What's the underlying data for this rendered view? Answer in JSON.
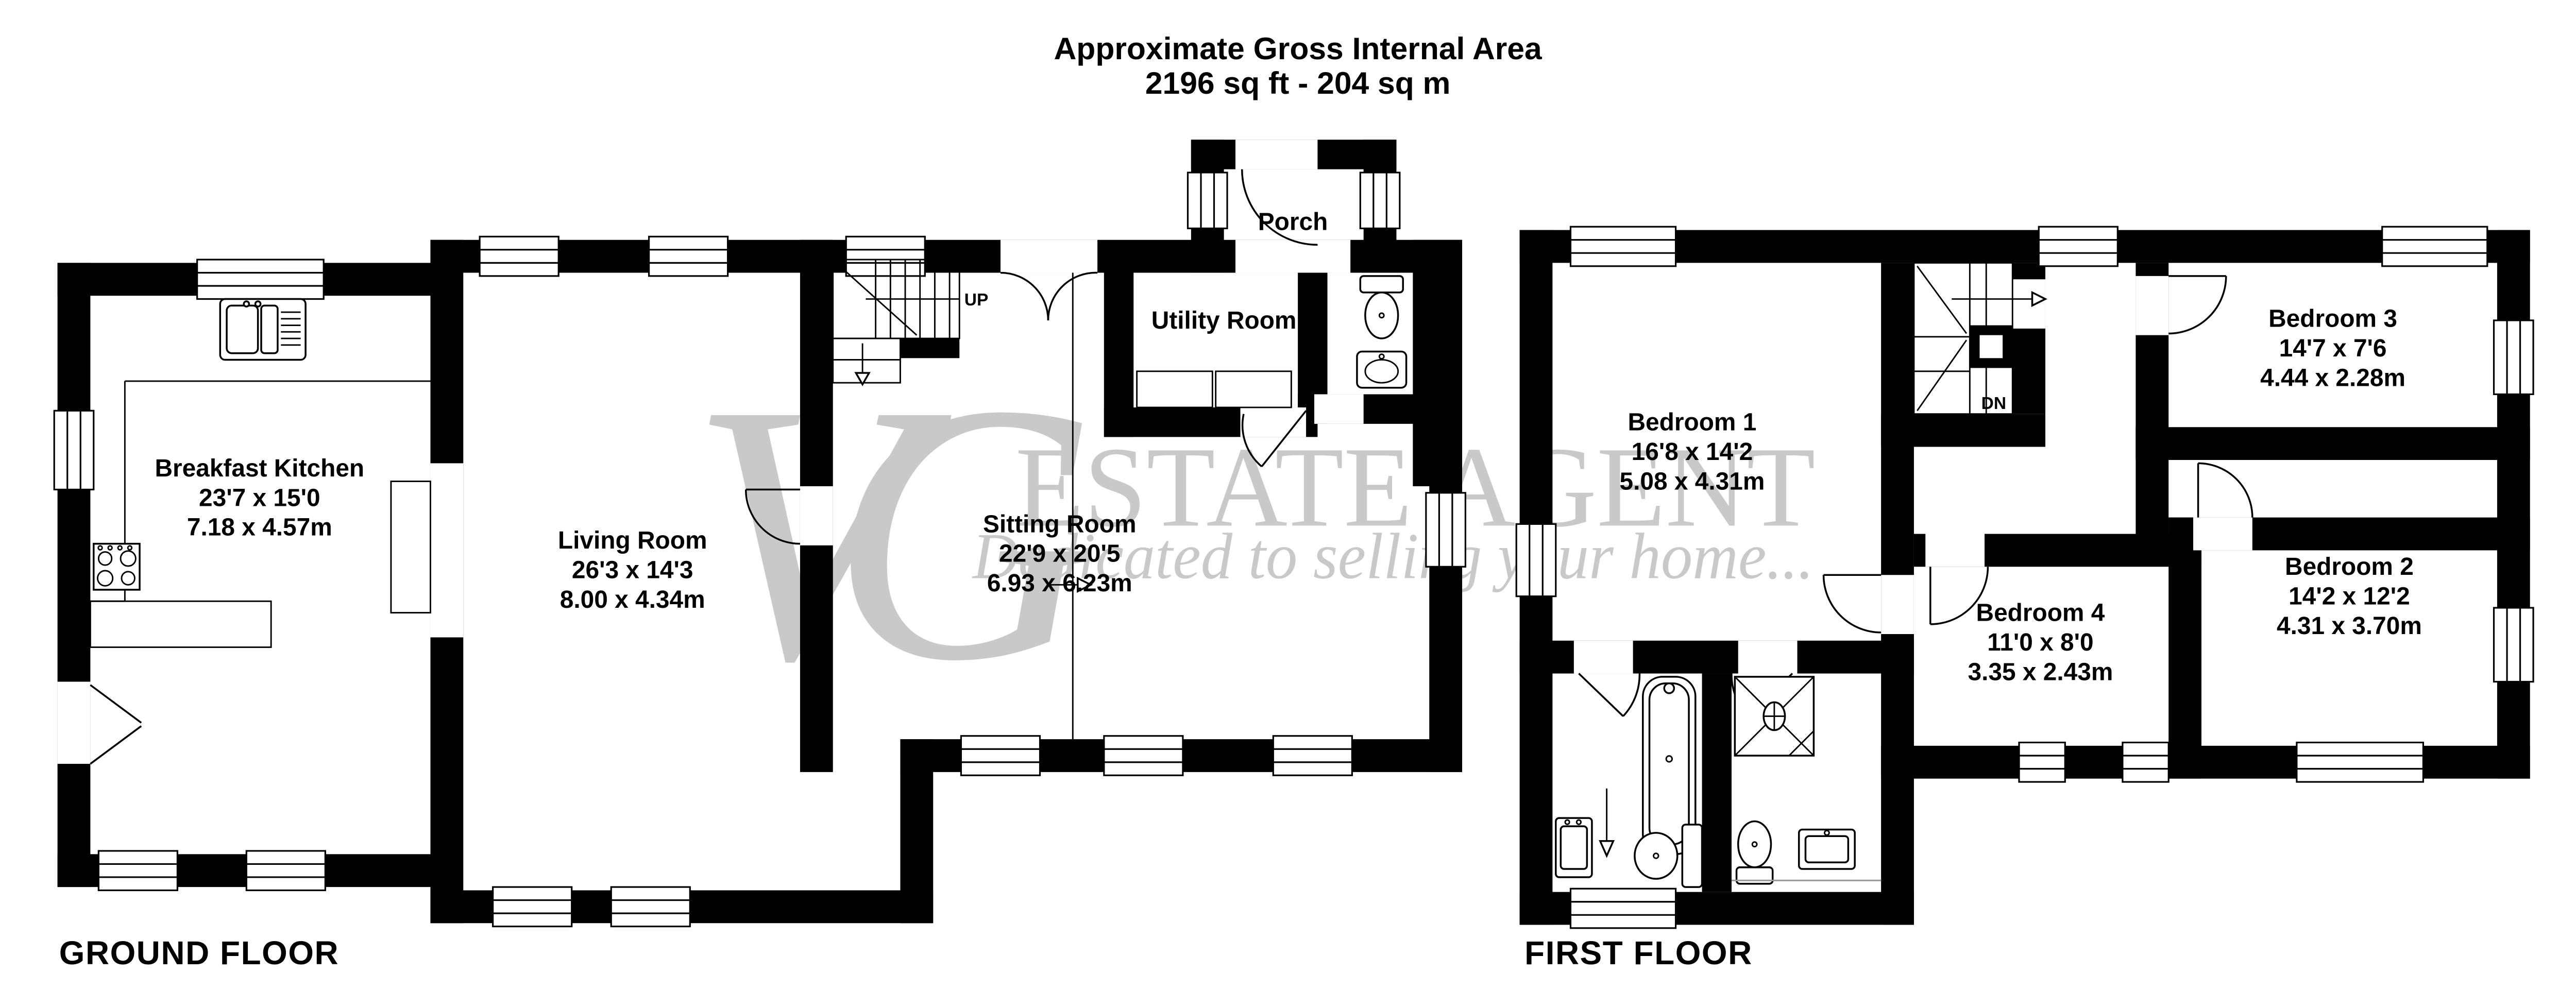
{
  "title": {
    "line1": "Approximate Gross Internal Area",
    "line2": "2196 sq ft - 204 sq m"
  },
  "floors": [
    {
      "name": "GROUND FLOOR",
      "stairs_label": "UP",
      "rooms": [
        {
          "name": "Breakfast Kitchen",
          "dims_ft": "23'7 x 15'0",
          "dims_m": "7.18 x 4.57m"
        },
        {
          "name": "Living Room",
          "dims_ft": "26'3 x 14'3",
          "dims_m": "8.00 x 4.34m"
        },
        {
          "name": "Sitting Room",
          "dims_ft": "22'9 x 20'5",
          "dims_m": "6.93 x 6.23m"
        },
        {
          "name": "Utility Room"
        },
        {
          "name": "Porch"
        }
      ]
    },
    {
      "name": "FIRST FLOOR",
      "stairs_label": "DN",
      "rooms": [
        {
          "name": "Bedroom 1",
          "dims_ft": "16'8 x 14'2",
          "dims_m": "5.08 x 4.31m"
        },
        {
          "name": "Bedroom 3",
          "dims_ft": "14'7 x 7'6",
          "dims_m": "4.44 x 2.28m"
        },
        {
          "name": "Bedroom 2",
          "dims_ft": "14'2 x 12'2",
          "dims_m": "4.31 x 3.70m"
        },
        {
          "name": "Bedroom 4",
          "dims_ft": "11'0 x 8'0",
          "dims_m": "3.35 x 2.43m"
        }
      ]
    }
  ],
  "watermark": {
    "monogram": "VG",
    "line1": "ESTATE AGENT",
    "line2": "Dedicated to selling your home..."
  },
  "colors": {
    "walls": "#000000",
    "watermark": "#c9c9c9",
    "background": "#ffffff"
  }
}
